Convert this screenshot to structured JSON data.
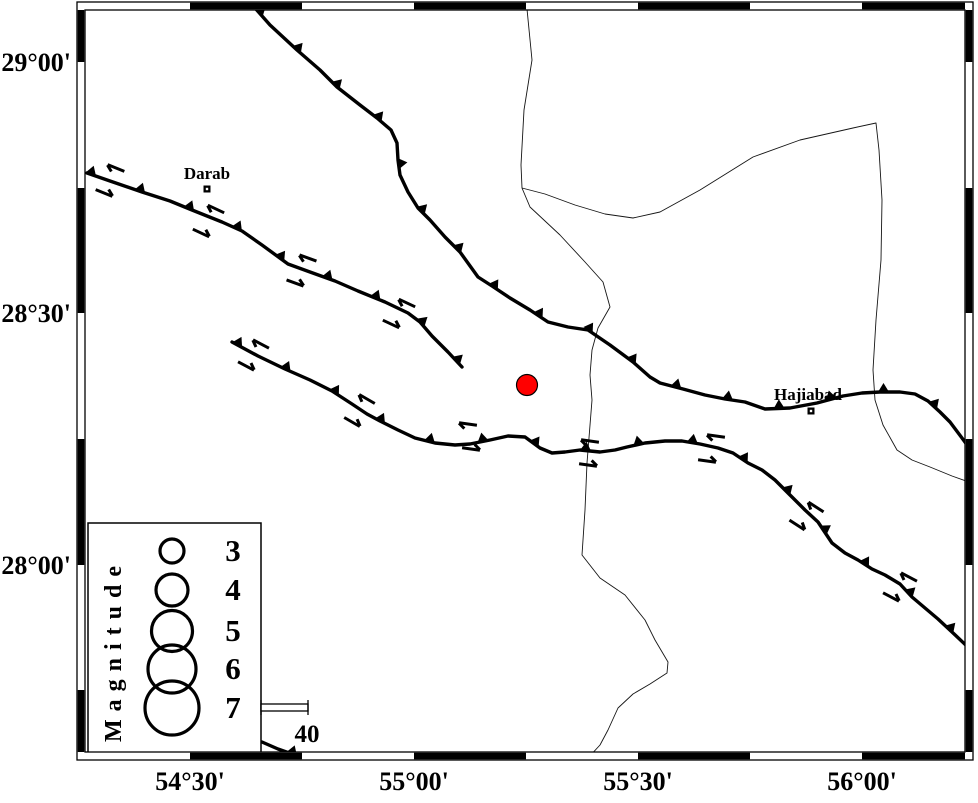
{
  "figure": {
    "width": 978,
    "height": 798,
    "background": "#ffffff"
  },
  "colors": {
    "ink": "#000000",
    "river": "#151515",
    "epicenter_fill": "#ff0000",
    "white": "#ffffff"
  },
  "map": {
    "frame": {
      "outer": {
        "x": 77,
        "y": 2,
        "w": 896,
        "h": 758
      },
      "inner": {
        "x": 85,
        "y": 10,
        "w": 880,
        "h": 742
      },
      "x_edges": [
        85,
        190,
        302,
        414,
        526,
        638,
        750,
        862,
        965
      ],
      "y_edges": [
        10,
        62,
        188,
        313,
        439,
        565,
        690,
        752
      ],
      "x_first_black": false,
      "y_first_black": true
    },
    "x_axis": {
      "label_y": 790,
      "ticks": [
        {
          "label": "54°30'",
          "x": 190
        },
        {
          "label": "55°00'",
          "x": 414
        },
        {
          "label": "55°30'",
          "x": 638
        },
        {
          "label": "56°00'",
          "x": 862
        }
      ]
    },
    "y_axis": {
      "label_x": 71,
      "ticks": [
        {
          "label": "29°00'",
          "y": 62
        },
        {
          "label": "28°30'",
          "y": 313
        },
        {
          "label": "28°00'",
          "y": 565
        }
      ]
    }
  },
  "rivers": [
    {
      "name": "river-main",
      "d": "M527,9 L532,60 L524,110 L521,165 L522,188 L530,207 L560,235 L585,262 L603,282 L610,307 L598,328 L592,350 L590,375 L592,400 L587,463 L585,510 L582,555 L600,578 L625,595 L645,620 L655,640 L668,662 L667,673 L650,684 L633,694 L618,708 L608,730 L600,745 L588,758"
    },
    {
      "name": "boundary-loop",
      "d": "M522,188 L545,194 L575,205 L605,214 L633,218 L660,212 L700,190 L753,157 L800,140 L853,128 L876,123 L879,150 L882,200 L881,260 L876,320 L873,370 L875,400 L883,425 L897,450 L912,460 L930,467 L952,476 L966,481"
    }
  ],
  "faults": [
    {
      "name": "fault-north",
      "d": "M255,8 L270,25 L297,50 L320,70 L337,87 L360,105 L377,118 L391,130 L397,143 L398,160 L400,175 L408,192 L418,208 L430,220 L445,237 L460,252 L478,277 L492,286 L510,298 L530,310 L548,322 L568,327 L588,330 L610,345 L633,362 L650,377 L660,383 L683,389 L705,395 L725,399 L745,402 L765,409 L790,408 L817,403 L843,396 L862,393 L880,392 L900,392 L915,394 L928,401 L940,412 L950,422 L962,438 L970,449",
      "teeth": {
        "offset": 6,
        "spacing": 53,
        "base": 11,
        "height": 9
      }
    },
    {
      "name": "fault-darab",
      "d": "M87,173 L110,181 L142,192 L170,201 L192,210 L222,222 L242,231 L262,245 L288,264 L310,272 L335,281 L358,291 L385,302 L408,313 L420,322 L432,336 L448,352 L462,367",
      "teeth": {
        "offset": 4,
        "spacing": 52,
        "base": 11,
        "height": 9
      }
    },
    {
      "name": "fault-south",
      "d": "M232,342 L258,356 L285,369 L310,380 L332,391 L352,404 L367,414 L380,421 L398,430 L415,438 L435,443 L455,445 L470,444 L490,440 L508,436 L525,437 L540,448 L552,453 L565,452 L580,450 L600,452 L615,450 L627,447 L645,443 L665,441 L682,441 L700,444 L718,448 L733,453 L748,463 L762,470 L775,480 L790,495 L805,510 L818,522 L832,543 L845,553 L858,560 L872,569 L885,575 L900,584 L912,597 L925,608 L938,619 L952,632 L970,649",
      "teeth": {
        "offset": 6,
        "spacing": 54,
        "base": 11,
        "height": 9
      }
    },
    {
      "name": "fault-bottom-edge",
      "d": "M262,742 L278,749 L295,755 L315,757 L340,759",
      "teeth": {
        "offset": 32,
        "spacing": 500,
        "base": 11,
        "height": 9
      }
    }
  ],
  "slip_arrows": [
    {
      "x": 116,
      "y": 168,
      "angle": 22,
      "barb": "left"
    },
    {
      "x": 104,
      "y": 193,
      "angle": 22,
      "barb": "right"
    },
    {
      "x": 216,
      "y": 209,
      "angle": 25,
      "barb": "left"
    },
    {
      "x": 201,
      "y": 233,
      "angle": 25,
      "barb": "right"
    },
    {
      "x": 308,
      "y": 258,
      "angle": 20,
      "barb": "left"
    },
    {
      "x": 295,
      "y": 283,
      "angle": 20,
      "barb": "right"
    },
    {
      "x": 407,
      "y": 303,
      "angle": 25,
      "barb": "left"
    },
    {
      "x": 391,
      "y": 324,
      "angle": 25,
      "barb": "right"
    },
    {
      "x": 261,
      "y": 344,
      "angle": 28,
      "barb": "left"
    },
    {
      "x": 246,
      "y": 366,
      "angle": 28,
      "barb": "right"
    },
    {
      "x": 367,
      "y": 399,
      "angle": 30,
      "barb": "left"
    },
    {
      "x": 352,
      "y": 422,
      "angle": 30,
      "barb": "right"
    },
    {
      "x": 468,
      "y": 424,
      "angle": 8,
      "barb": "left"
    },
    {
      "x": 471,
      "y": 449,
      "angle": 8,
      "barb": "right"
    },
    {
      "x": 590,
      "y": 441,
      "angle": 8,
      "barb": "left"
    },
    {
      "x": 588,
      "y": 465,
      "angle": 8,
      "barb": "right"
    },
    {
      "x": 716,
      "y": 436,
      "angle": 8,
      "barb": "left"
    },
    {
      "x": 707,
      "y": 461,
      "angle": 8,
      "barb": "right"
    },
    {
      "x": 816,
      "y": 507,
      "angle": 33,
      "barb": "left"
    },
    {
      "x": 797,
      "y": 525,
      "angle": 33,
      "barb": "right"
    },
    {
      "x": 909,
      "y": 577,
      "angle": 28,
      "barb": "left"
    },
    {
      "x": 891,
      "y": 597,
      "angle": 28,
      "barb": "right"
    }
  ],
  "earthquake": {
    "x": 527,
    "y": 385,
    "r": 10.5
  },
  "places": [
    {
      "label": "Darab",
      "x": 207,
      "y": 189,
      "label_x": 207,
      "label_y": 179
    },
    {
      "label": "Hajiabad",
      "x": 811,
      "y": 411,
      "label_x": 808,
      "label_y": 400
    }
  ],
  "legend": {
    "title": "Magnitude",
    "box": {
      "x": 88,
      "y": 523,
      "w": 173,
      "h": 230
    },
    "title_x": 121,
    "title_y": 742,
    "symbol_cx": 172,
    "label_cx": 233,
    "items": [
      {
        "label": "3",
        "cy": 551,
        "r": 12
      },
      {
        "label": "4",
        "cy": 590,
        "r": 16
      },
      {
        "label": "5",
        "cy": 631,
        "r": 20.5
      },
      {
        "label": "6",
        "cy": 669,
        "r": 24
      },
      {
        "label": "7",
        "cy": 708,
        "r": 27
      }
    ]
  },
  "scale_bar": {
    "label": "40",
    "x": 261,
    "y": 704,
    "w": 47,
    "h": 7,
    "cap_rise": 4,
    "label_x": 307,
    "label_y": 742
  }
}
